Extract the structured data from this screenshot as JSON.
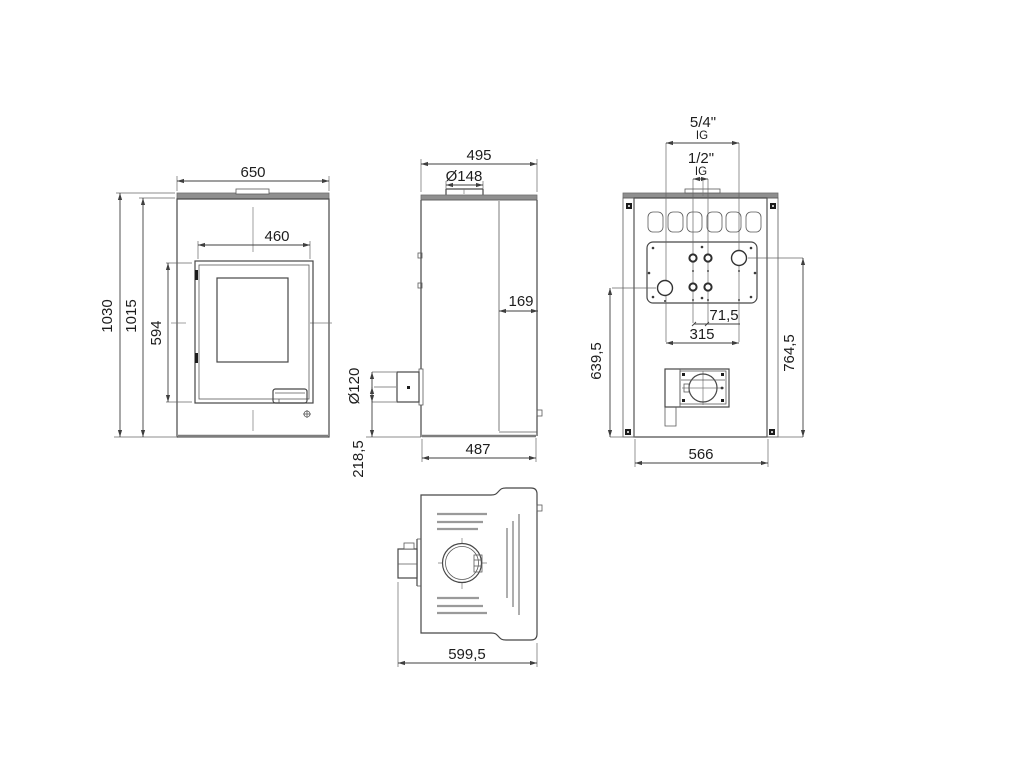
{
  "title": "stove-technical-drawing",
  "colors": {
    "line": "#474747",
    "plate_fill": "#8f8f8f",
    "background": "#ffffff"
  },
  "views": {
    "front": {
      "width": "650",
      "door_width": "460",
      "glass_height": "594",
      "total_height": "1030",
      "body_height": "1015"
    },
    "side": {
      "depth": "495",
      "flue_diameter": "Ø148",
      "front_gap": "169",
      "socket_diameter": "Ø120",
      "socket_center_height": "218,5",
      "base_depth": "487"
    },
    "back": {
      "boiler_thread": "5/4\"",
      "boiler_thread_type": "IG",
      "sensor_thread": "1/2\"",
      "sensor_thread_type": "IG",
      "sensor_spacing": "71,5",
      "boiler_spacing": "315",
      "tapping_height_left": "639,5",
      "tapping_height_right": "764,5",
      "width": "566"
    },
    "top": {
      "depth_overall": "599,5"
    }
  }
}
